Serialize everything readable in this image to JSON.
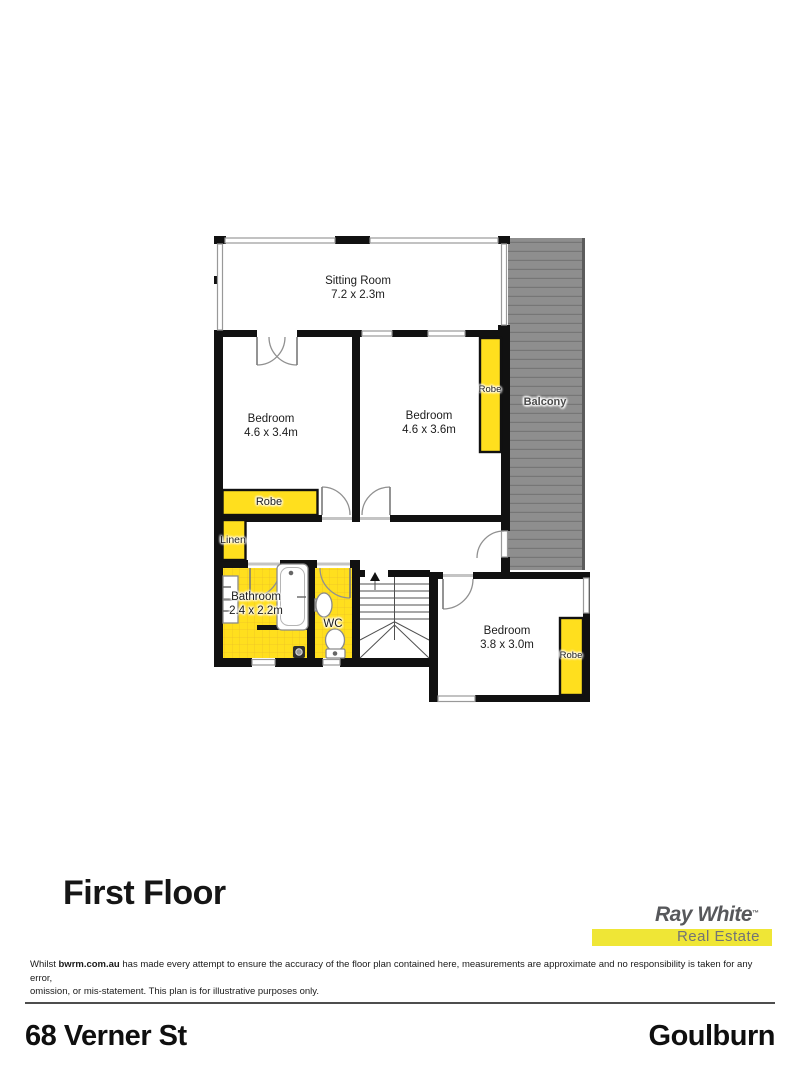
{
  "page": {
    "floor_title": "First Floor",
    "footer_left": "68 Verner St",
    "footer_right": "Goulburn"
  },
  "logo": {
    "brand": "Ray White",
    "tm": "™",
    "tagline": "Real Estate",
    "brand_color": "#57585b",
    "bar_color": "#efe636"
  },
  "disclaimer": {
    "prefix": "Whilst ",
    "bold": "bwrm.com.au",
    "line1_rest": " has made every attempt to ensure the accuracy of the floor plan contained here, measurements are approximate and no responsibility is taken for any error,",
    "line2": "omission, or mis-statement. This plan is for illustrative purposes only."
  },
  "floorplan": {
    "rooms": {
      "sitting": {
        "name": "Sitting Room",
        "dims": "7.2 x 2.3m"
      },
      "bedroom1": {
        "name": "Bedroom",
        "dims": "4.6 x 3.4m"
      },
      "bedroom2": {
        "name": "Bedroom",
        "dims": "4.6 x 3.6m"
      },
      "bedroom3": {
        "name": "Bedroom",
        "dims": "3.8 x 3.0m"
      },
      "bathroom": {
        "name": "Bathroom",
        "dims": "2.4 x 2.2m"
      },
      "wc": {
        "name": "WC"
      },
      "balcony": {
        "name": "Balcony"
      },
      "linen": {
        "name": "Linen"
      },
      "robe1": {
        "name": "Robe"
      },
      "robe2": {
        "name": "Robe"
      },
      "robe3": {
        "name": "Robe"
      }
    },
    "colors": {
      "wall": "#111111",
      "highlight_yellow": "#ffdf1e",
      "balcony_gray": "#8e8e8e",
      "window_frame": "#999999"
    }
  }
}
